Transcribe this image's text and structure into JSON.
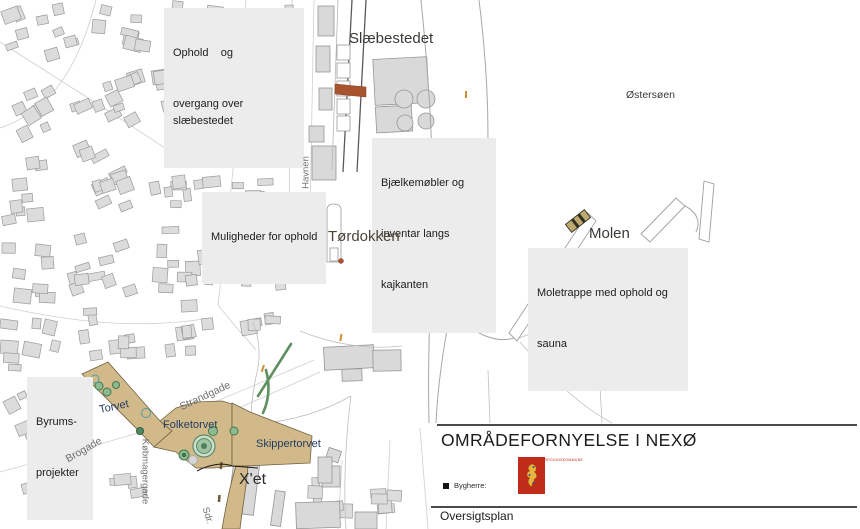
{
  "map": {
    "annotation_boxes": [
      {
        "id": "ophold-overgang",
        "lines": [
          "Ophold    og",
          "overgang over slæbestedet"
        ]
      },
      {
        "id": "muligheder-ophold",
        "lines": [
          "Muligheder for ophold"
        ]
      },
      {
        "id": "bjaelkemoebler",
        "lines": [
          "Bjælkemøbler og",
          "inventar langs",
          "kajkanten"
        ]
      },
      {
        "id": "moletrappe",
        "lines": [
          "Moletrappe med ophold og",
          "sauna"
        ]
      },
      {
        "id": "byrumsprojekter",
        "lines": [
          "Byrums-",
          "projekter"
        ]
      }
    ],
    "place_labels": [
      {
        "id": "slaebestedet",
        "text": "Slæbestedet"
      },
      {
        "id": "toerdokken",
        "text": "Tørdokken"
      },
      {
        "id": "molen",
        "text": "Molen"
      },
      {
        "id": "oestersoeen",
        "text": "Østersøen"
      },
      {
        "id": "xet",
        "text": "X'et"
      },
      {
        "id": "torvet",
        "text": "Torvet"
      },
      {
        "id": "folketorvet",
        "text": "Folketorvet"
      },
      {
        "id": "skippertorvet",
        "text": "Skippertorvet"
      }
    ],
    "street_labels": [
      {
        "id": "havnen",
        "text": "Havnen"
      },
      {
        "id": "strandgade",
        "text": "Strandgade"
      },
      {
        "id": "brogade",
        "text": "Brogade"
      },
      {
        "id": "koebmagergade",
        "text": "Købmagergade"
      },
      {
        "id": "sdr",
        "text": "Sdr."
      }
    ]
  },
  "title_block": {
    "title": "OMRÅDEFORNYELSE I NEXØ",
    "client_label": "Bygherre:",
    "client_logo_caption": "BORNHOLMS REGIONSKOMMUNE",
    "plan_type": "Oversigtsplan"
  },
  "colors": {
    "project-tan": "#d2b98a",
    "project-tan-outline": "#70603f",
    "accent-rust": "#a8552f",
    "hedge-green": "#5e8f5e",
    "building-fill": "#dcdcdc",
    "building-stroke": "#9a9a9a",
    "label-box-bg": "#ececec",
    "street-label": "#6f6f6f",
    "navy-label": "#1f3a5f",
    "orange-tick": "#cc8f33",
    "logo-red": "#bf2c1a",
    "logo-yellow": "#e8b43c"
  }
}
